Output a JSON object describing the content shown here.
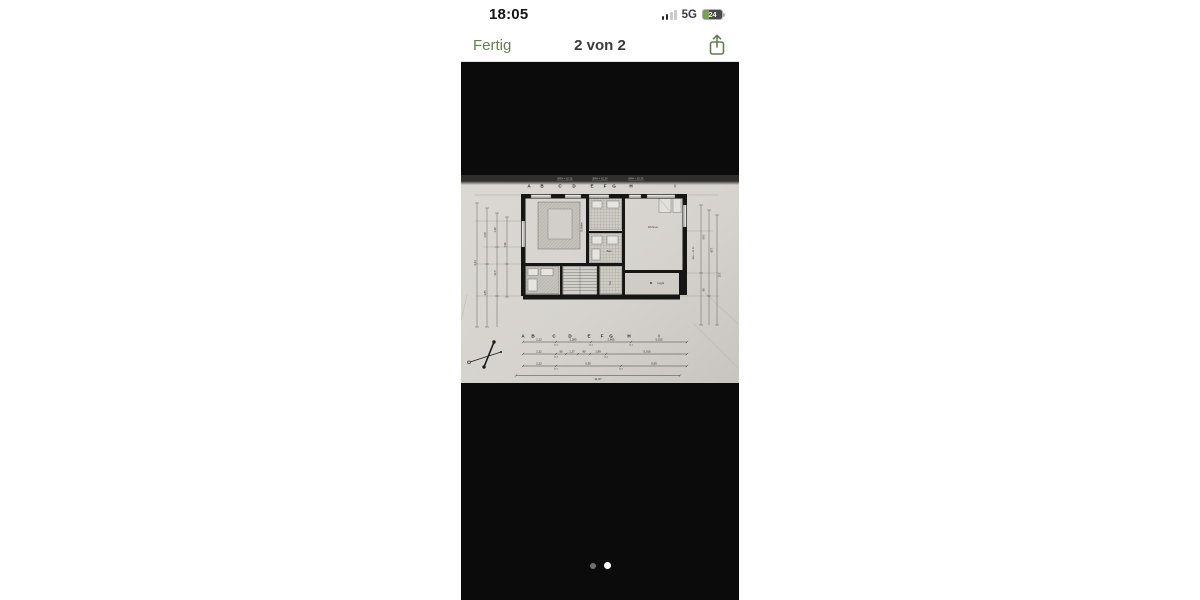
{
  "status_bar": {
    "time": "18:05",
    "network": "5G",
    "battery_percent": "24",
    "signal_icon": "cellular-bars"
  },
  "nav_bar": {
    "done_label": "Fertig",
    "title": "2 von 2",
    "share_icon": "share-up-arrow"
  },
  "viewer": {
    "page_dots": {
      "total": 2,
      "current": 2
    }
  },
  "floor_plan": {
    "grid_letters": [
      "A",
      "B",
      "C",
      "D",
      "E",
      "F",
      "G",
      "H",
      "I"
    ],
    "header_notes": [
      "BRH = 62,36",
      "BRH = 62,24",
      "BRH + 62,36"
    ],
    "side_note": "BRH + 62,36",
    "room_labels": {
      "bedroom": "Schlafen",
      "bath": "Bad",
      "living": "Wohnen",
      "hall": "Flur",
      "loggia": "Loggia"
    },
    "dims": {
      "row1": [
        "2,22",
        "2,285",
        "2,665",
        "5,015"
      ],
      "row2": [
        "2,22",
        "90",
        "1,27",
        "80",
        "1,99",
        "5,015"
      ],
      "row3": [
        "2,22",
        "5,30",
        "5,50"
      ],
      "wall": "11,5",
      "total": "11,97",
      "left": [
        "3,44",
        "2,08",
        "1,85",
        "1,38",
        "92,5",
        "1,96"
      ],
      "right": [
        "2,60",
        "1,38",
        "3,51",
        "86"
      ]
    }
  },
  "colors": {
    "accent_green": "#637d54",
    "paper": "#d6d3ce",
    "viewer_bg": "#0b0b0b",
    "battery_green": "#74a44f"
  }
}
